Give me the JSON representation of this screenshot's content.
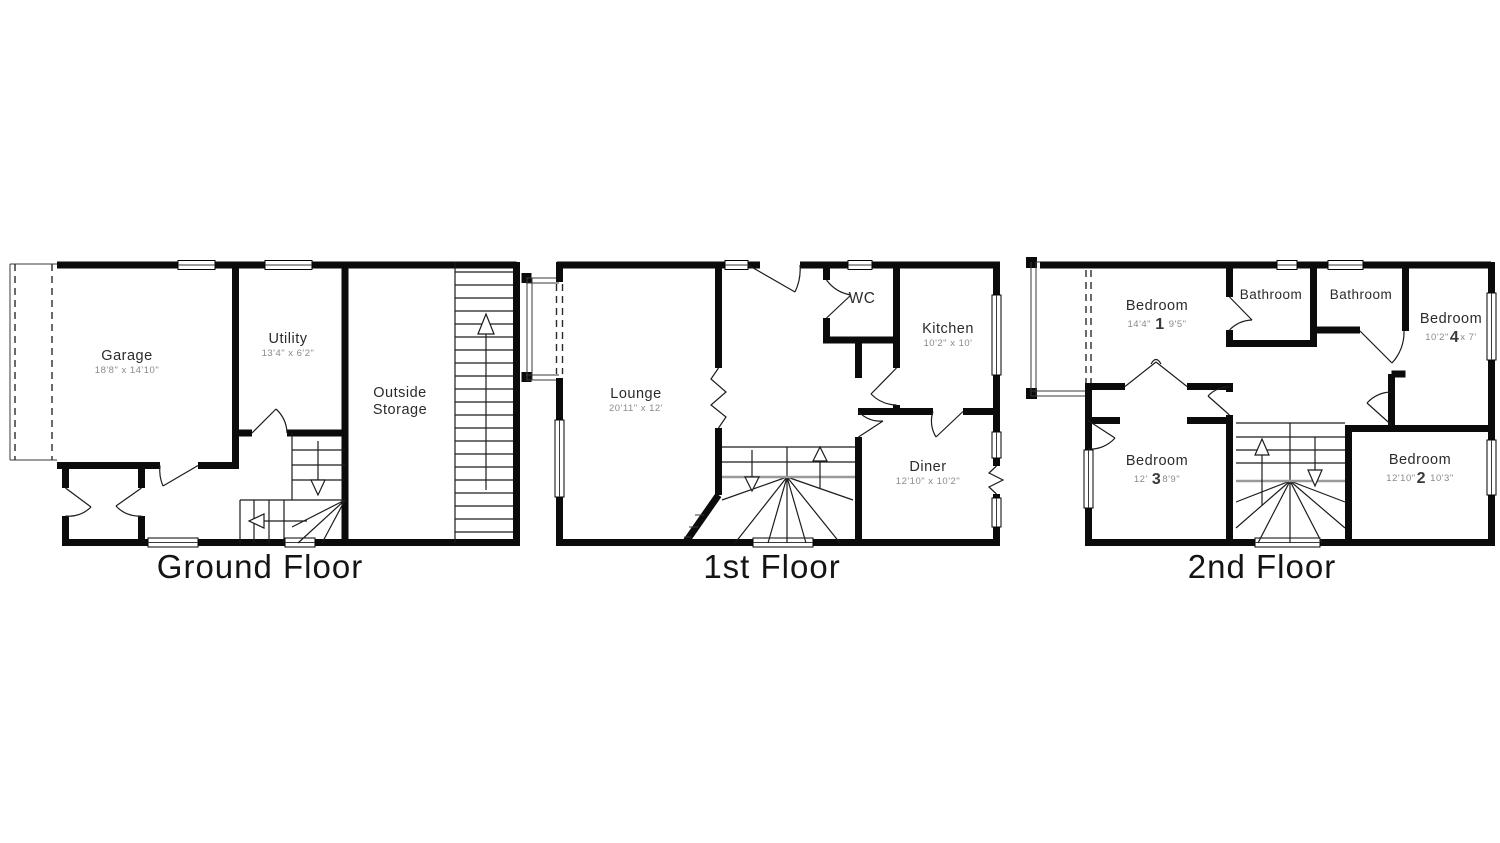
{
  "floors": [
    {
      "title": "Ground Floor",
      "rooms": {
        "garage": {
          "name": "Garage",
          "size": "18'8\" x 14'10\""
        },
        "utility": {
          "name": "Utility",
          "size": "13'4\" x 6'2\""
        },
        "outside_storage": {
          "name_line1": "Outside",
          "name_line2": "Storage"
        }
      }
    },
    {
      "title": "1st Floor",
      "rooms": {
        "lounge": {
          "name": "Lounge",
          "size": "20'11\" x 12'"
        },
        "wc": {
          "name": "WC"
        },
        "kitchen": {
          "name": "Kitchen",
          "size": "10'2\" x 10'"
        },
        "diner": {
          "name": "Diner",
          "size": "12'10\" x 10'2\""
        }
      }
    },
    {
      "title": "2nd Floor",
      "rooms": {
        "bedroom1": {
          "name": "Bedroom",
          "number": "1",
          "size_a": "14'4\"",
          "size_b": "9'5\""
        },
        "bathroom1": {
          "name": "Bathroom"
        },
        "bathroom2": {
          "name": "Bathroom"
        },
        "bedroom4": {
          "name": "Bedroom",
          "number": "4",
          "size_a": "10'2\"",
          "size_b": "x 7'"
        },
        "bedroom3": {
          "name": "Bedroom",
          "number": "3",
          "size_a": "12'",
          "size_b": "8'9\""
        },
        "bedroom2": {
          "name": "Bedroom",
          "number": "2",
          "size_a": "12'10\"",
          "size_b": "10'3\""
        }
      }
    }
  ]
}
